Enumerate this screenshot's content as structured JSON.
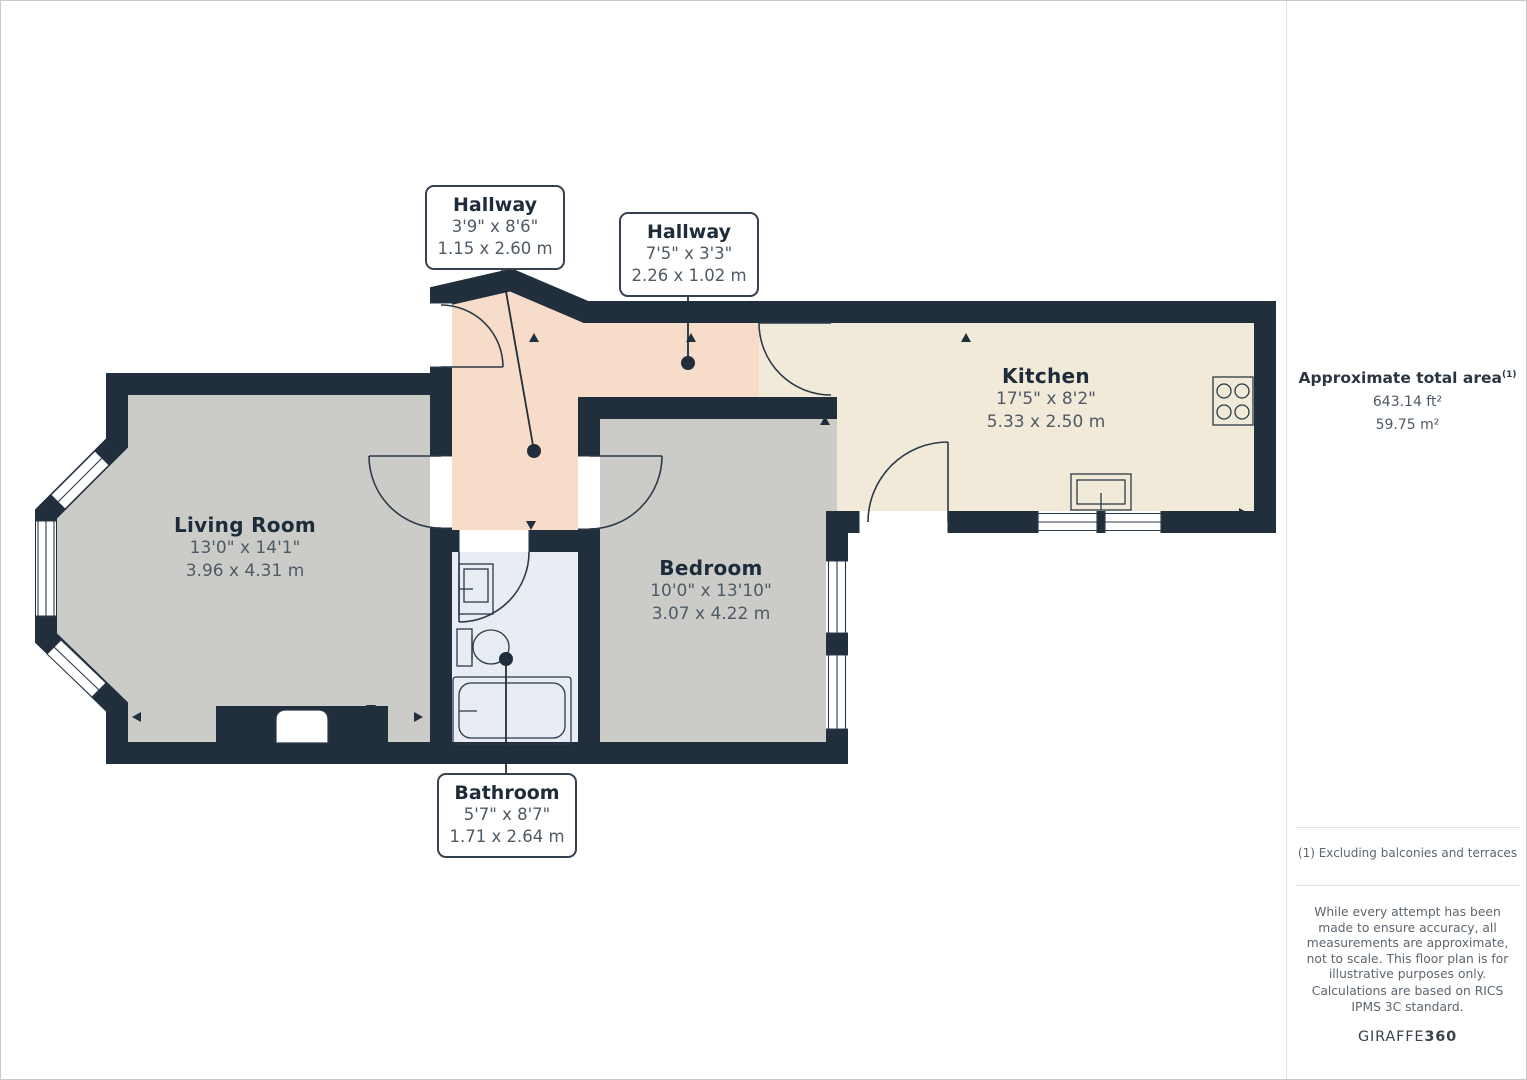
{
  "theme": {
    "wall": "#212f3d",
    "floor_gray": "#cbccc7",
    "floor_hall": "#f6dcc9",
    "floor_kitchen": "#f1ead8",
    "floor_bath": "#e8edf4",
    "line": "#2b3a49",
    "label_title": "#1d2b3a",
    "label_dim": "#4e5a66",
    "muted": "#5c6670",
    "divider": "#e3e3e3",
    "page_border": "#c9c9c9"
  },
  "floorplan": {
    "rooms": [
      {
        "id": "living_room",
        "name": "Living Room",
        "dims_imperial": "13'0\" x 14'1\"",
        "dims_metric": "3.96 x 4.31 m"
      },
      {
        "id": "hallway_1",
        "name": "Hallway",
        "dims_imperial": "3'9\" x 8'6\"",
        "dims_metric": "1.15 x 2.60 m"
      },
      {
        "id": "hallway_2",
        "name": "Hallway",
        "dims_imperial": "7'5\" x 3'3\"",
        "dims_metric": "2.26 x 1.02 m"
      },
      {
        "id": "kitchen",
        "name": "Kitchen",
        "dims_imperial": "17'5\" x 8'2\"",
        "dims_metric": "5.33 x 2.50 m"
      },
      {
        "id": "bedroom",
        "name": "Bedroom",
        "dims_imperial": "10'0\" x 13'10\"",
        "dims_metric": "3.07 x 4.22 m"
      },
      {
        "id": "bathroom",
        "name": "Bathroom",
        "dims_imperial": "5'7\" x 8'7\"",
        "dims_metric": "1.71 x 2.64 m"
      }
    ]
  },
  "sidebar": {
    "area_title": "Approximate total area",
    "area_sup": "(1)",
    "area_ft": "643.14 ft²",
    "area_m": "59.75 m²",
    "footnote": "(1) Excluding balconies and terraces",
    "disclaimer1": "While every attempt has been made to ensure accuracy, all measurements are approximate, not to scale. This floor plan is for illustrative purposes only.",
    "disclaimer2": "Calculations are based on RICS IPMS 3C standard.",
    "brand_regular": "GIRAFFE",
    "brand_bold": "360"
  }
}
